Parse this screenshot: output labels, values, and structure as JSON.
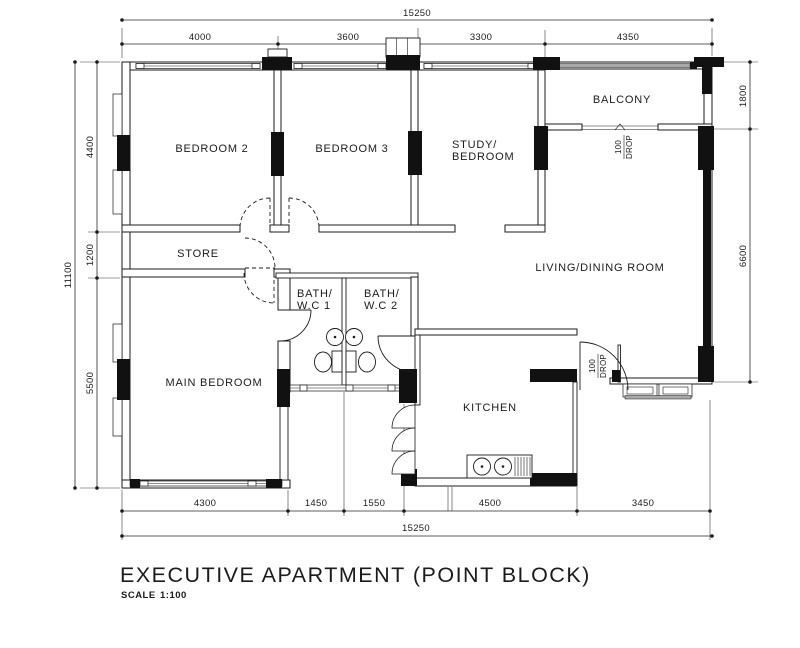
{
  "title": "EXECUTIVE APARTMENT (POINT BLOCK)",
  "scale": {
    "label": "SCALE",
    "value": "1:100"
  },
  "rooms": {
    "bedroom2": "BEDROOM 2",
    "bedroom3": "BEDROOM 3",
    "study_line1": "STUDY/",
    "study_line2": "BEDROOM",
    "balcony": "BALCONY",
    "living": "LIVING/DINING  ROOM",
    "store": "STORE",
    "main_bedroom": "MAIN  BEDROOM",
    "bath1_line1": "BATH/",
    "bath1_line2": "W.C  1",
    "bath2_line1": "BATH/",
    "bath2_line2": "W.C  2",
    "kitchen": "KITCHEN"
  },
  "annotations": {
    "drop_balcony": [
      "100",
      "DROP"
    ],
    "drop_kitchen": [
      "100",
      "DROP"
    ]
  },
  "dimensions": {
    "top_total": "15250",
    "top": [
      "4000",
      "3600",
      "3300",
      "4350"
    ],
    "left_total": "11100",
    "left": [
      "4400",
      "1200",
      "5500"
    ],
    "right": [
      "1800",
      "6600"
    ],
    "bottom": [
      "4300",
      "1450",
      "1550",
      "4500",
      "3450"
    ],
    "bottom_total": "15250"
  },
  "colors": {
    "line": "#1b1b1b",
    "background": "#ffffff",
    "rail_gray": "#a9a9a9"
  }
}
